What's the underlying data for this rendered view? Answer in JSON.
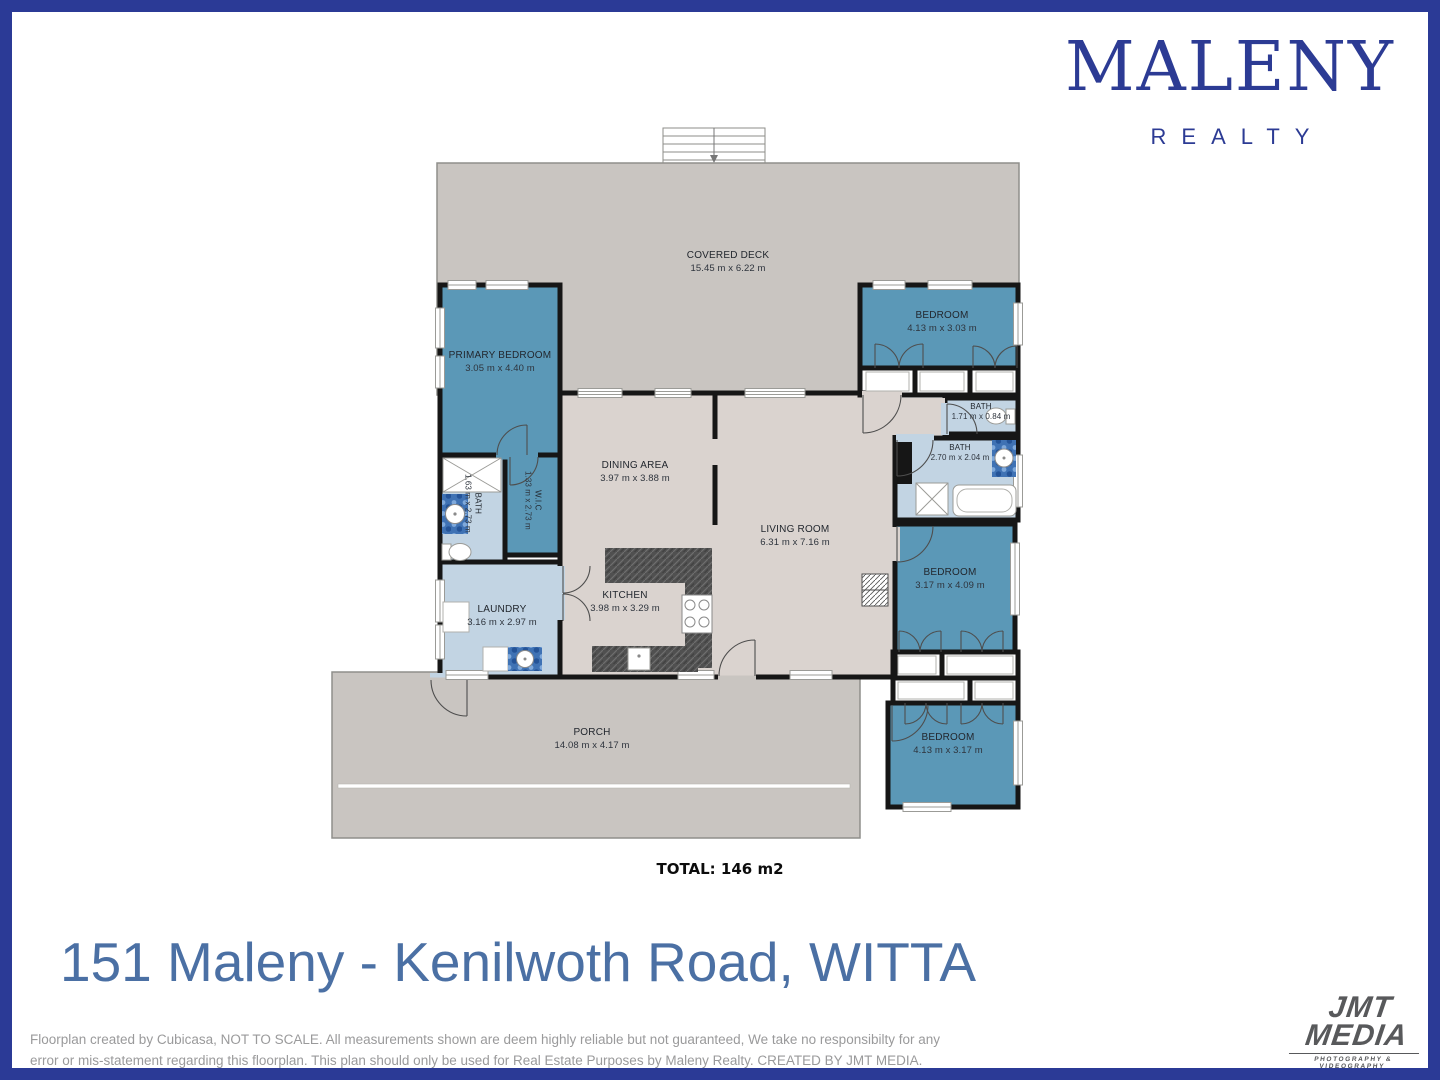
{
  "colors": {
    "navy": "#2B3A96",
    "logo_navy": "#2C3B94",
    "teal": "#5B98B7",
    "light_blue": "#C2D4E3",
    "deck_gray": "#C9C5C1",
    "floor_beige": "#DAD3CF",
    "wall": "#161616",
    "address_blue": "#4B70A4",
    "disclaimer_gray": "#9A9A9B",
    "jmt_gray": "#58595B"
  },
  "brand": {
    "name": "MALENY",
    "tagline": "REALTY"
  },
  "floorplan": {
    "total_label": "TOTAL: 146 m2",
    "rooms": {
      "covered_deck": {
        "name": "COVERED DECK",
        "dims": "15.45 m x 6.22 m"
      },
      "primary_bedroom": {
        "name": "PRIMARY BEDROOM",
        "dims": "3.05 m x 4.40 m"
      },
      "bedroom_top_right": {
        "name": "BEDROOM",
        "dims": "4.13 m x 3.03 m"
      },
      "bath_small": {
        "name": "BATH",
        "dims": "1.71 m x 0.84 m"
      },
      "bath_ensuite": {
        "name": "BATH",
        "dims": "2.70 m x 2.04 m"
      },
      "wic": {
        "name": "W.I.C",
        "dims": "1.33 m x 2.73 m"
      },
      "bath_left": {
        "name": "BATH",
        "dims": "1.63 m x 2.73 m"
      },
      "dining": {
        "name": "DINING AREA",
        "dims": "3.97 m x 3.88 m"
      },
      "living": {
        "name": "LIVING ROOM",
        "dims": "6.31 m x 7.16 m"
      },
      "kitchen": {
        "name": "KITCHEN",
        "dims": "3.98 m x 3.29 m"
      },
      "laundry": {
        "name": "LAUNDRY",
        "dims": "3.16 m x 2.97 m"
      },
      "bedroom_mid_right": {
        "name": "BEDROOM",
        "dims": "3.17 m x 4.09 m"
      },
      "bedroom_bottom_right": {
        "name": "BEDROOM",
        "dims": "4.13 m x 3.17 m"
      },
      "porch": {
        "name": "PORCH",
        "dims": "14.08 m x 4.17 m"
      }
    }
  },
  "address": "151 Maleny - Kenilwoth Road, WITTA",
  "disclaimer": {
    "line1": "Floorplan created by Cubicasa, NOT TO SCALE. All measurements shown are deem highly reliable but not guaranteed,  We take no responsibilty for any",
    "line2": "error or mis-statement regarding this floorplan. This plan should only be used for Real Estate Purposes by Maleny Realty. CREATED BY JMT MEDIA."
  },
  "jmt_logo": {
    "line1": "JMT",
    "line2": "MEDIA",
    "tagline": "PHOTOGRAPHY & VIDEOGRAPHY"
  }
}
